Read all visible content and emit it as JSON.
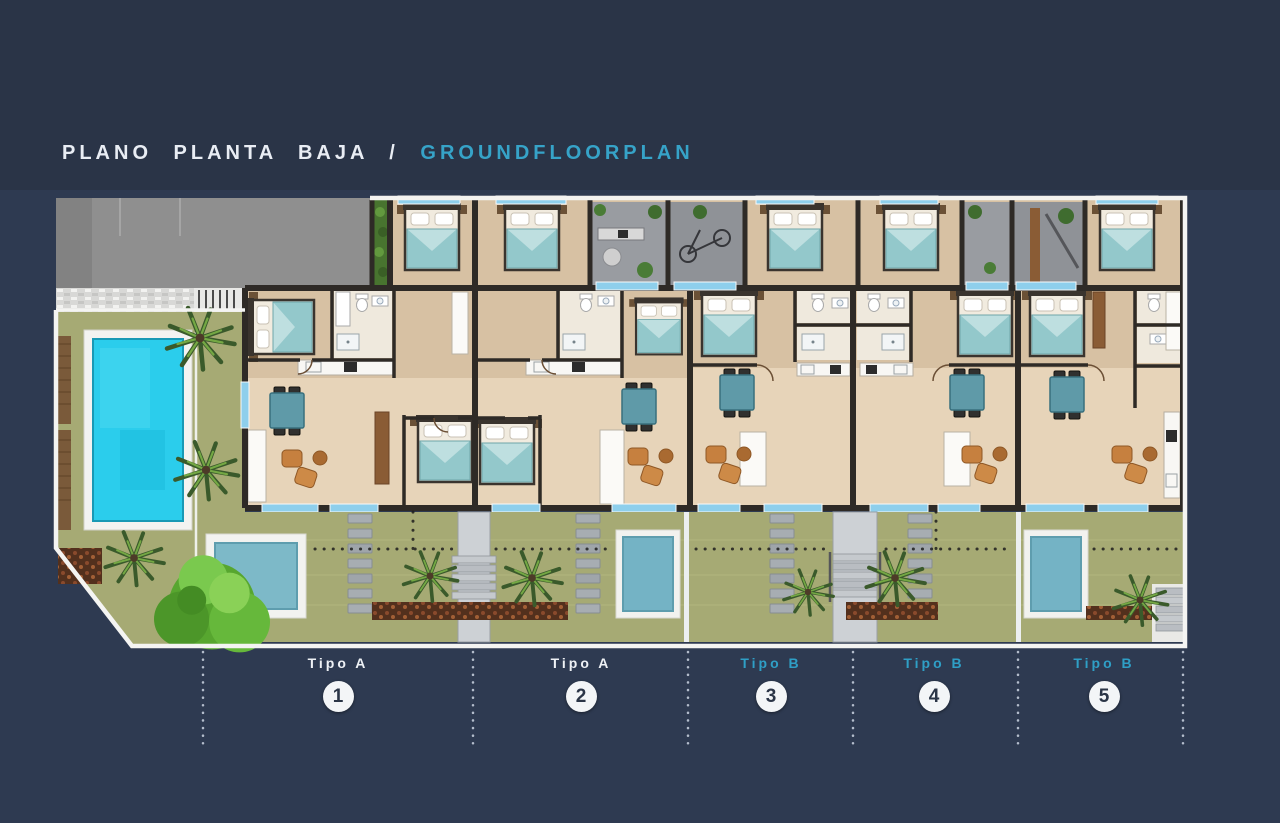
{
  "title": {
    "spanish": "PLANO PLANTA BAJA",
    "separator": "/",
    "english": "GROUNDFLOORPLAN",
    "text_color": "#e9edf4",
    "accent_color": "#36a3c8"
  },
  "units": [
    {
      "label": "Tipo A",
      "number": "1",
      "type": "A",
      "label_color": "#eef1f5"
    },
    {
      "label": "Tipo A",
      "number": "2",
      "type": "A",
      "label_color": "#eef1f5"
    },
    {
      "label": "Tipo B",
      "number": "3",
      "type": "B",
      "label_color": "#2f9fc6"
    },
    {
      "label": "Tipo B",
      "number": "4",
      "type": "B",
      "label_color": "#2f9fc6"
    },
    {
      "label": "Tipo B",
      "number": "5",
      "type": "B",
      "label_color": "#2f9fc6"
    }
  ],
  "plan": {
    "colors": {
      "page_background": "#2a3447",
      "plan_band_background": "#2e3a51",
      "wall": "#2e2a26",
      "white_outline": "#f4f4f2",
      "floor_living": "#e7d4b9",
      "floor_bedroom": "#d7c1a3",
      "patio_gray": "#999ca1",
      "driveway_gray": "#8f8f8f",
      "garden_green": "#a6aa74",
      "communal_pool": "#2bcdec",
      "plunge_pool": "#77b6c7",
      "glazing_blue": "#8ecfec",
      "bed_cover_teal": "#93c8cb",
      "dining_table_teal": "#5f9aa8",
      "sofa_orange": "#c6803f",
      "tree_green": "#5fb335"
    }
  }
}
